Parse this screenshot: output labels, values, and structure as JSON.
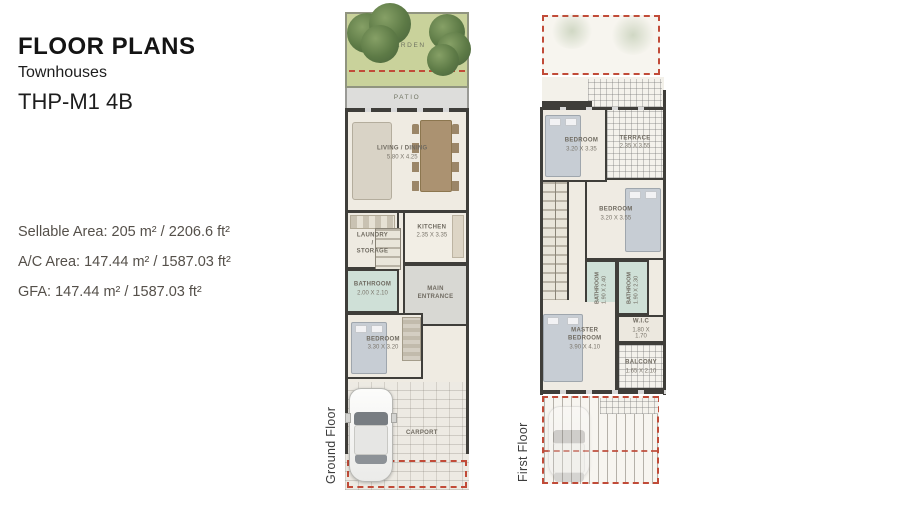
{
  "header": {
    "title": "FLOOR PLANS",
    "subtitle": "Townhouses",
    "model": "THP-M1 4B"
  },
  "areas": {
    "sellable": "Sellable Area: 205 m² / 2206.6 ft²",
    "ac": "A/C Area: 147.44 m² / 1587.03 ft²",
    "gfa": "GFA: 147.44 m² / 1587.03 ft²"
  },
  "ground_floor": {
    "label": "Ground Floor",
    "garden": {
      "name": "GARDEN"
    },
    "patio": {
      "name": "PATIO"
    },
    "living_dining": {
      "name": "LIVING / DINING",
      "dims": "5.80 X 4.25"
    },
    "kitchen": {
      "name": "KITCHEN",
      "dims": "2.35 X 3.35"
    },
    "laundry": {
      "name": "LAUNDRY /\nSTORAGE"
    },
    "bathroom": {
      "name": "BATHROOM",
      "dims": "2.00 X 2.10"
    },
    "main_entrance": {
      "name": "MAIN\nENTRANCE"
    },
    "bedroom": {
      "name": "BEDROOM",
      "dims": "3.30 X 3.20"
    },
    "carport": {
      "name": "CARPORT"
    }
  },
  "first_floor": {
    "label": "First Floor",
    "bedroom1": {
      "name": "BEDROOM",
      "dims": "3.20 X 3.35"
    },
    "terrace": {
      "name": "TERRACE",
      "dims": "2.35 X 3.55"
    },
    "bedroom2": {
      "name": "BEDROOM",
      "dims": "3.20 X 3.55"
    },
    "bathroom1": {
      "name": "BATHROOM",
      "dims": "1.90 X 2.40"
    },
    "bathroom2": {
      "name": "BATHROOM",
      "dims": "1.90 X 2.30"
    },
    "wic": {
      "name": "W.I.C",
      "dims": "1.80 X 1.70"
    },
    "master_bedroom": {
      "name": "MASTER\nBEDROOM",
      "dims": "3.90 X 4.10"
    },
    "balcony": {
      "name": "BALCONY",
      "dims": "1.65 X 2.10"
    }
  },
  "colors": {
    "accent_dash": "#c14b38",
    "wall": "#3f3e3a",
    "garden_green": "#c9d29b",
    "bath_teal": "#cfe0d7"
  }
}
